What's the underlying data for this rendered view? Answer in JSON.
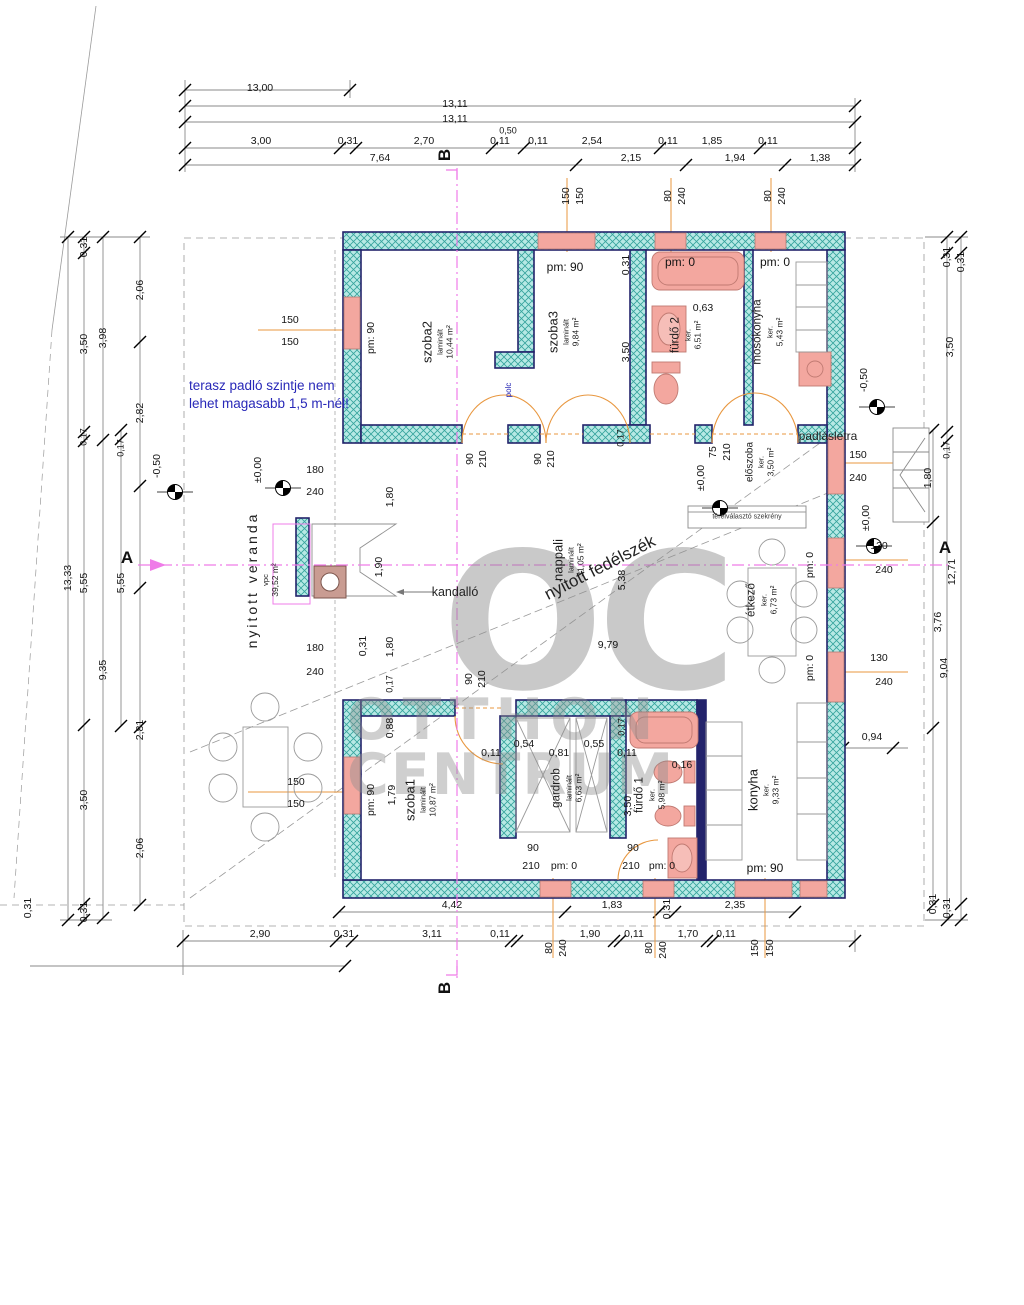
{
  "watermark": {
    "monogram": "OC",
    "line1": "OTTHON",
    "line2": "CENTRUM"
  },
  "note": {
    "line1": "terasz padló szintje nem",
    "line2": "lehet magasabb 1,5 m-nél!"
  },
  "sections": {
    "a": "A",
    "b": "B"
  },
  "texts": {
    "kandallo": "kandalló",
    "nyitott_fedelszek": "nyitott fedélszék",
    "polc": "polc",
    "padlasletra": "padláslétra",
    "terelvalaszto": "térelválasztó szekrény"
  },
  "rooms": [
    {
      "name": "szoba2",
      "floor": "laminált",
      "area": "10,44 m²"
    },
    {
      "name": "szoba3",
      "floor": "laminált",
      "area": "9,84 m²"
    },
    {
      "name": "fürdő 2",
      "floor": "ker.",
      "area": "6,51 m²"
    },
    {
      "name": "mosókonyha",
      "floor": "ker.",
      "area": "5,43 m²"
    },
    {
      "name": "előszoba",
      "floor": "ker.",
      "area": "3,50 m²"
    },
    {
      "name": "nappali",
      "floor": "laminált",
      "area": "31,05 m²"
    },
    {
      "name": "étkező",
      "floor": "ker.",
      "area": "6,73 m²"
    },
    {
      "name": "szoba1",
      "floor": "laminált",
      "area": "10,87 m²"
    },
    {
      "name": "gardrob",
      "floor": "laminált",
      "area": "6,63 m²"
    },
    {
      "name": "fürdő 1",
      "floor": "ker.",
      "area": "5,98 m²"
    },
    {
      "name": "konyha",
      "floor": "ker.",
      "area": "9,33 m²"
    },
    {
      "name": "nyitott veranda",
      "floor": "vpc",
      "area": "39,52 m²"
    }
  ],
  "dims": {
    "top": [
      "13,00",
      "13,11",
      "13,11",
      "0,50",
      "3,00",
      "0,31",
      "2,70",
      "0,11",
      "0,11",
      "2,54",
      "0,11",
      "1,85",
      "0,11",
      "7,64",
      "2,15",
      "1,94",
      "1,38"
    ],
    "bottom": [
      "4,42",
      "1,83",
      "0,31",
      "2,35",
      "2,90",
      "0,31",
      "3,11",
      "0,11",
      "1,90",
      "0,11",
      "1,70",
      "0,11",
      "80",
      "240",
      "80",
      "240",
      "150",
      "150"
    ],
    "left": [
      "13,33",
      "0,31",
      "3,50",
      "0,17",
      "5,55",
      "3,50",
      "0,31",
      "3,98",
      "9,35",
      "0,17",
      "5,55",
      "2,06",
      "2,82",
      "2,81",
      "2,06",
      "-0,50",
      "0,31"
    ],
    "right": [
      "0,31",
      "0,31",
      "3,50",
      "0,17",
      "1,80",
      "12,71",
      "3,76",
      "9,04",
      "0,31",
      "0,31",
      "0,94",
      "150",
      "240",
      "130",
      "240",
      "130",
      "240",
      "-0,50",
      "±0,00"
    ],
    "inner": [
      "pm: 90",
      "150",
      "150",
      "±0,00",
      "180",
      "240",
      "180",
      "240",
      "0,31",
      "1,80",
      "1,90",
      "1,80",
      "0,17",
      "90",
      "210",
      "90",
      "210",
      "pm: 90",
      "0,31",
      "3,50",
      "0,17",
      "150",
      "150",
      "0,63",
      "pm: 0",
      "80",
      "240",
      "pm: 0",
      "80",
      "240",
      "75",
      "210",
      "±0,00",
      "5,38",
      "9,79",
      "90",
      "210",
      "pm: 0",
      "pm: 0",
      "pm: 90",
      "0,88",
      "1,79",
      "150",
      "150",
      "0,11",
      "0,54",
      "0,81",
      "0,55",
      "0,11",
      "0,17",
      "3,50",
      "0,16",
      "pm: 90",
      "90",
      "210",
      "pm: 0",
      "90",
      "210",
      "pm: 0"
    ]
  }
}
